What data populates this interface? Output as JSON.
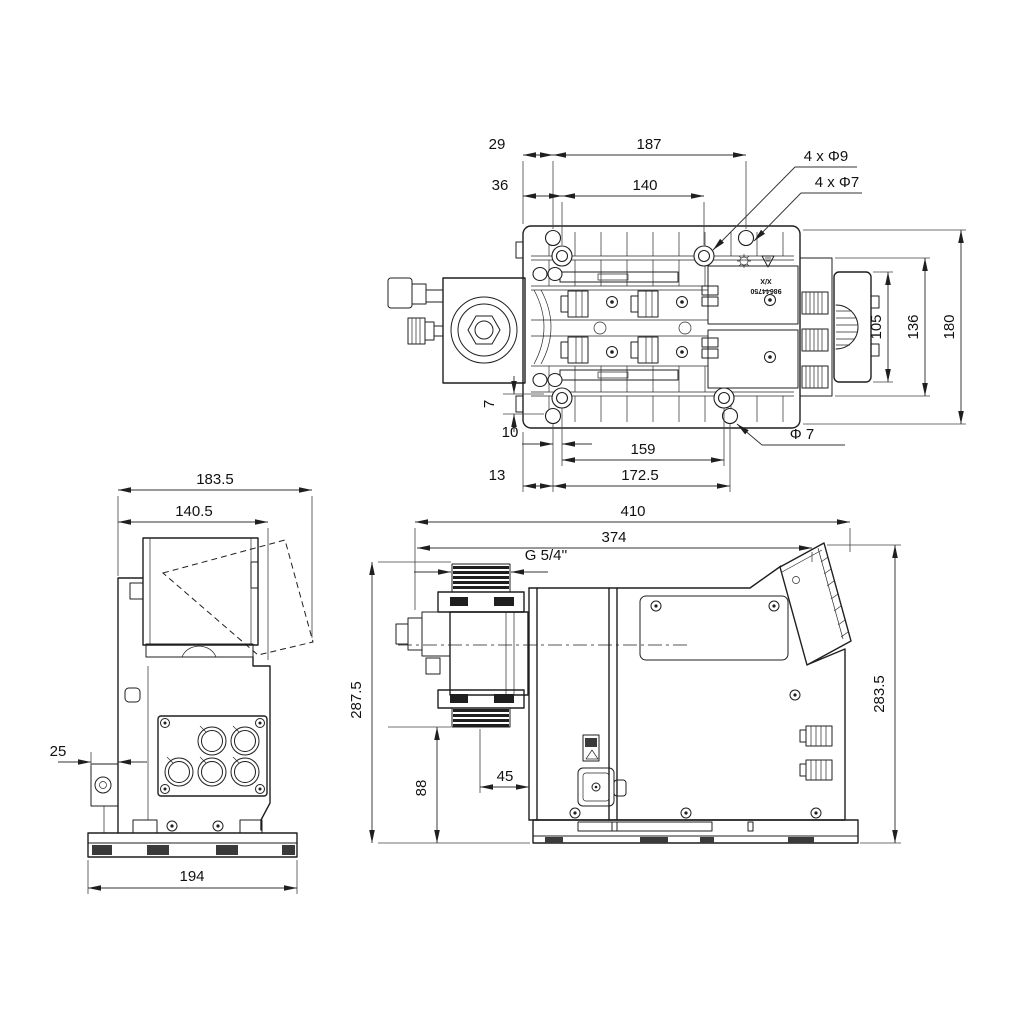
{
  "page": {
    "background": "#ffffff",
    "line_color": "#1f1f1f"
  },
  "views": {
    "top": {
      "name": "pump top view",
      "dims": {
        "d29": "29",
        "d187": "187",
        "d36": "36",
        "d140": "140",
        "d105": "105",
        "d136": "136",
        "d180": "180",
        "d7": "7",
        "d10": "10",
        "d159": "159",
        "d13": "13",
        "d172_5": "172.5",
        "dia7": "Φ 7",
        "holes9": "4 x Φ9",
        "holes7": "4 x Φ7"
      },
      "marking": {
        "line1": "X/X",
        "line2": "98644750"
      }
    },
    "side": {
      "name": "pump left side view",
      "dims": {
        "d183_5": "183.5",
        "d140_5": "140.5",
        "d25": "25",
        "d194": "194"
      }
    },
    "front": {
      "name": "pump front view",
      "dims": {
        "d410": "410",
        "d374": "374",
        "d287_5": "287.5",
        "d283_5": "283.5",
        "d88": "88",
        "d45": "45",
        "thread": "G 5/4''"
      }
    }
  }
}
